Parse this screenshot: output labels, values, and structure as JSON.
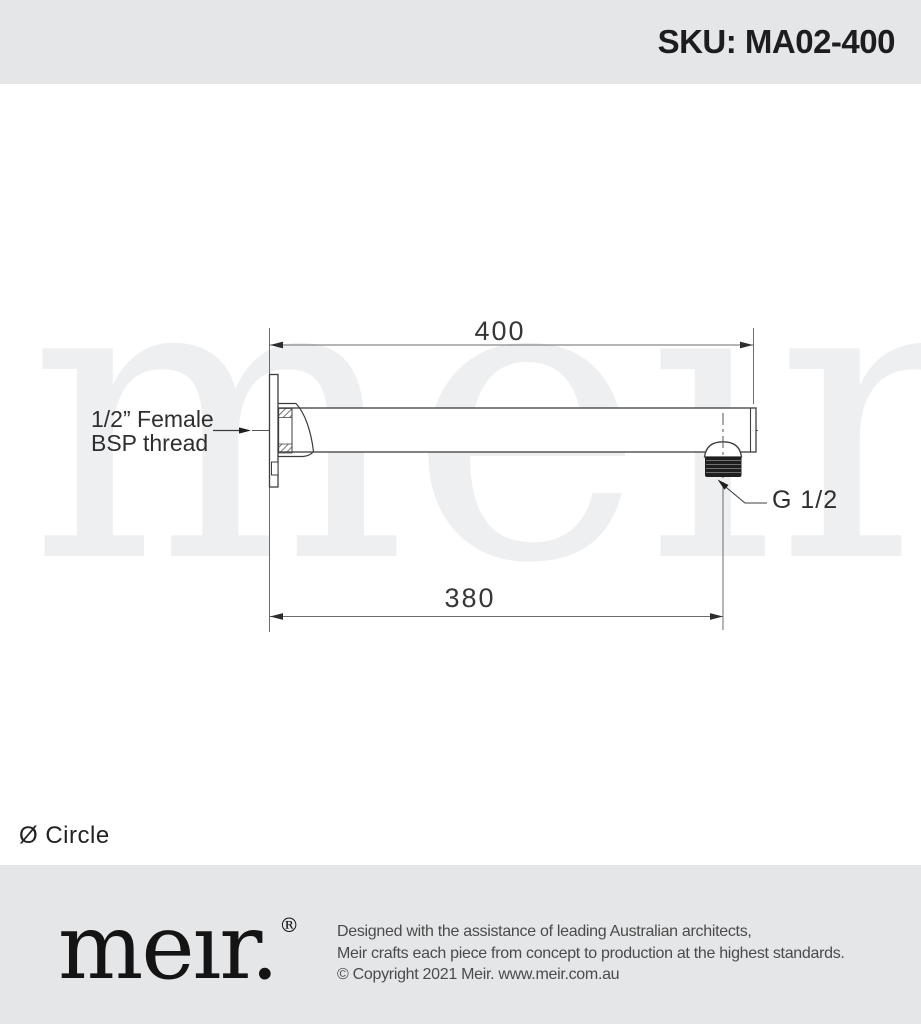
{
  "header": {
    "sku": "SKU: MA02-400"
  },
  "diagram": {
    "watermark": "meır.",
    "dimensions": {
      "overall_length": "400",
      "wall_to_outlet": "380"
    },
    "labels": {
      "inlet": "1/2” Female\nBSP thread",
      "outlet": "G 1/2"
    },
    "note": "Ø Circle"
  },
  "footer": {
    "logo": "meır.",
    "registered": "®",
    "lines": [
      "Designed with the assistance of leading Australian architects,",
      "Meir crafts each piece from concept to production at the highest standards.",
      "© Copyright 2021 Meir. www.meir.com.au"
    ]
  },
  "colors": {
    "band": "#e5e6e8",
    "object_line": "#3d3d3d",
    "dim_line": "#666666",
    "thread_fill": "#1e1e1e",
    "watermark": "#edeff1"
  }
}
